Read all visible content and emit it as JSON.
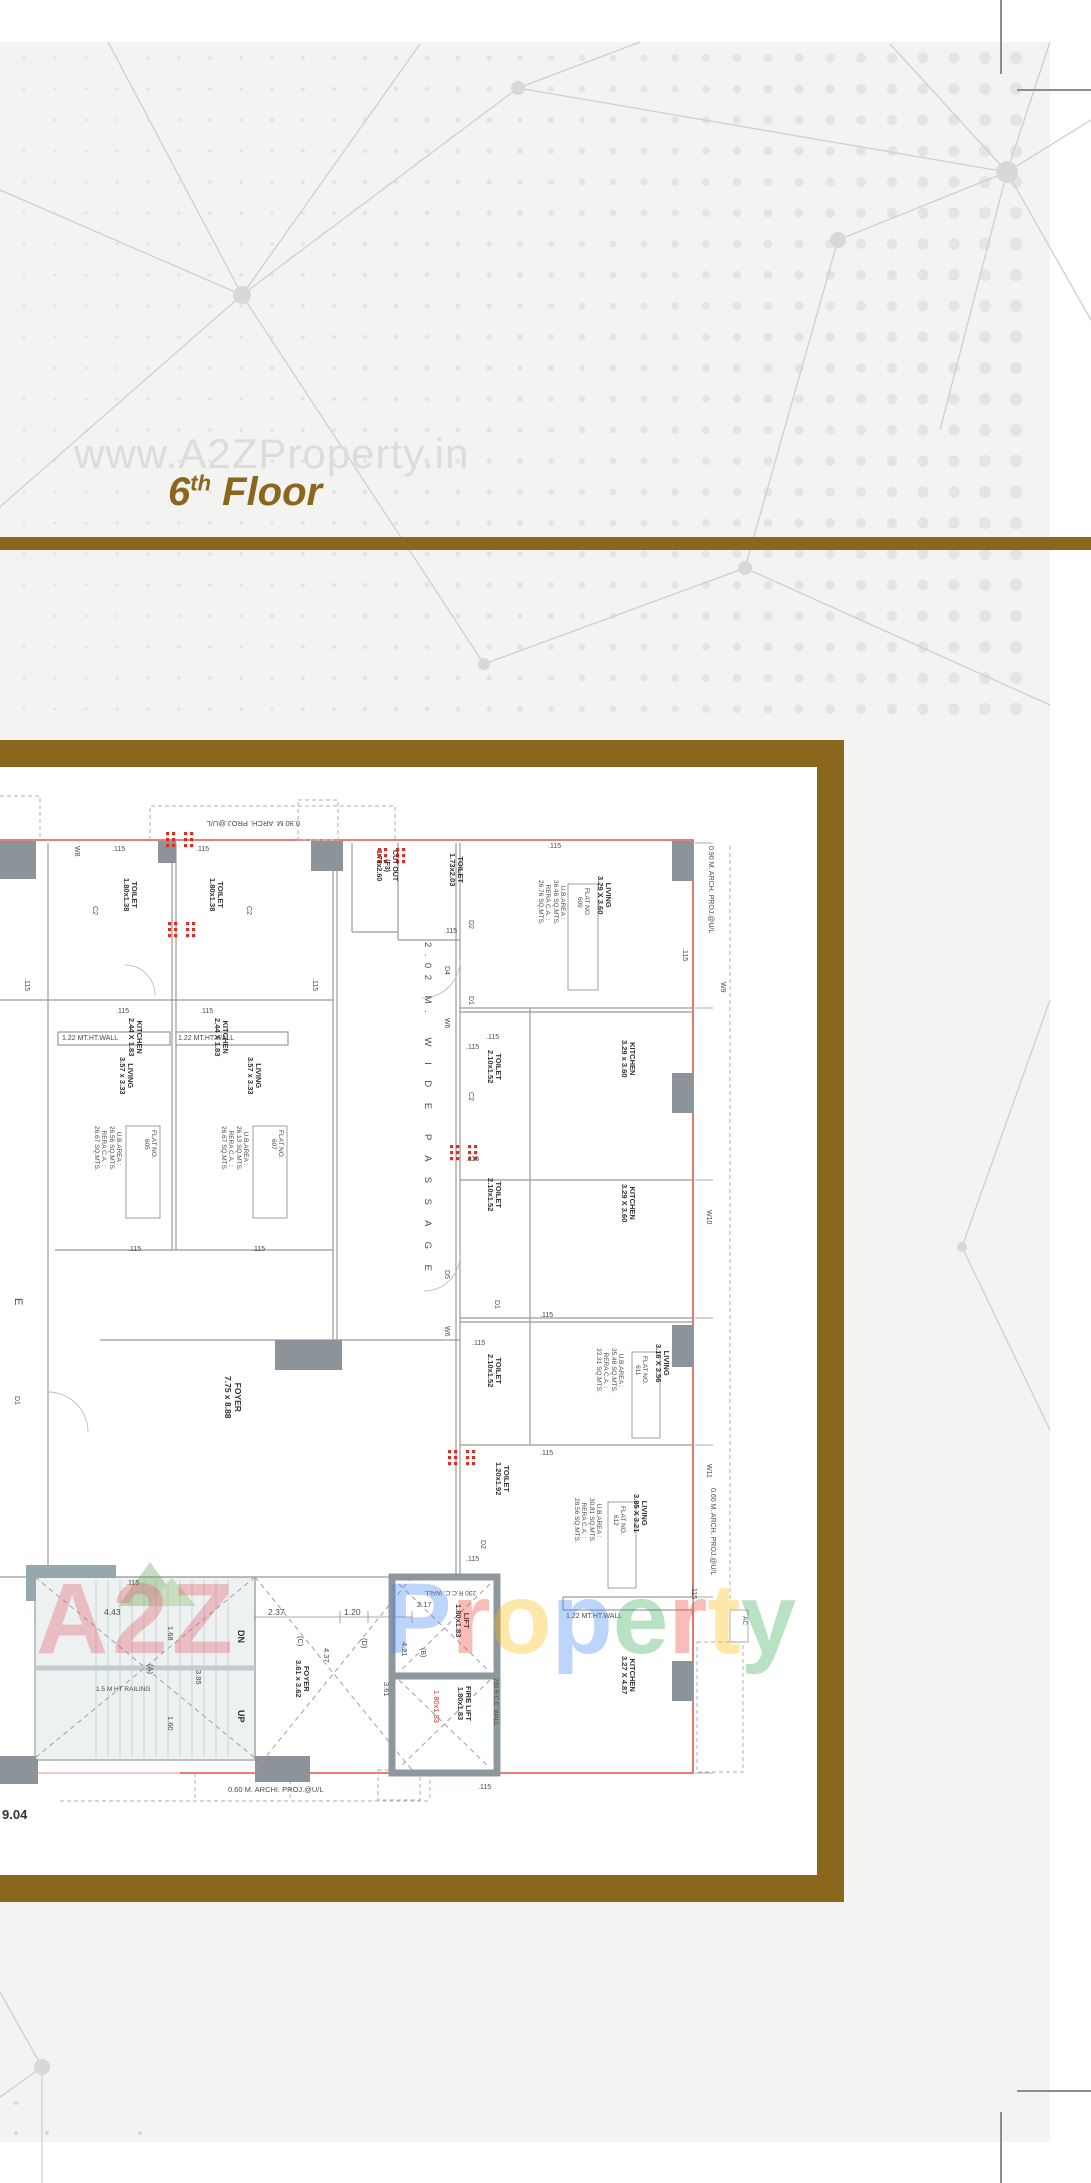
{
  "header": {
    "watermark": "www.A2ZProperty.in",
    "title": {
      "number": "6",
      "sup": "th",
      "word": " Floor"
    }
  },
  "brand_watermark": {
    "a2z": "A2Z",
    "property": "Property",
    "logo": "mountain-logo"
  },
  "colors": {
    "accent_brown": "#8a671d",
    "background_gray": "#f3f3f2",
    "plan_red_line": "#e0574d",
    "red_dot": "#d93025",
    "wm_a2z": "#e25b64",
    "wm_letters": [
      "#4285F4",
      "#EA4335",
      "#FBBC05",
      "#4285F4",
      "#34A853",
      "#EA4335",
      "#FBBC05",
      "#34A853"
    ]
  },
  "plan": {
    "labels": [
      {
        "t": "0.90 M. ARCH. PROJ.@U/L",
        "x": 300,
        "y": 827,
        "r": 180,
        "s": 7.5
      },
      {
        "t": "W8",
        "x": 80,
        "y": 846,
        "r": 90,
        "s": 7
      },
      {
        "t": ".115",
        "x": 112,
        "y": 846,
        "r": 0,
        "s": 7
      },
      {
        "t": ".115",
        "x": 196,
        "y": 846,
        "r": 0,
        "s": 7
      },
      {
        "t": ".115",
        "x": 548,
        "y": 843,
        "r": 0,
        "s": 7
      },
      {
        "t": "TOILET\n1.80x1.38",
        "x": 138,
        "y": 878,
        "r": 90,
        "s": 7.5,
        "b": 1
      },
      {
        "t": "TOILET\n1.80x1.38",
        "x": 224,
        "y": 878,
        "r": 90,
        "s": 7.5,
        "b": 1
      },
      {
        "t": "C2",
        "x": 98,
        "y": 906,
        "r": 90,
        "s": 7
      },
      {
        "t": "C2",
        "x": 252,
        "y": 906,
        "r": 90,
        "s": 7
      },
      {
        "t": "CUT OUT\n(F3)\n1.73x2.60",
        "x": 398,
        "y": 850,
        "r": 90,
        "s": 7,
        "b": 1
      },
      {
        "t": "TOILET\n1.73x2.03",
        "x": 464,
        "y": 853,
        "r": 90,
        "s": 7.5,
        "b": 1
      },
      {
        "t": ".115",
        "x": 444,
        "y": 928,
        "r": 0,
        "s": 7
      },
      {
        "t": ".115",
        "x": 30,
        "y": 978,
        "r": 90,
        "s": 7
      },
      {
        "t": ".115",
        "x": 318,
        "y": 978,
        "r": 90,
        "s": 7
      },
      {
        "t": ".115",
        "x": 116,
        "y": 1008,
        "r": 0,
        "s": 7
      },
      {
        "t": ".115",
        "x": 200,
        "y": 1008,
        "r": 0,
        "s": 7
      },
      {
        "t": "KITCHEN\n2.44 X 1.83",
        "x": 143,
        "y": 1018,
        "r": 90,
        "s": 7.5,
        "b": 1
      },
      {
        "t": "KITCHEN\n2.44 X 1.83",
        "x": 229,
        "y": 1018,
        "r": 90,
        "s": 7.5,
        "b": 1
      },
      {
        "t": "1.22 MT.HT.WALL",
        "x": 62,
        "y": 1035,
        "r": 0,
        "s": 7
      },
      {
        "t": "1.22 MT.HT.WALL",
        "x": 178,
        "y": 1035,
        "r": 0,
        "s": 7
      },
      {
        "t": "LIVING\n3.57 x 3.33",
        "x": 134,
        "y": 1057,
        "r": 90,
        "s": 7.5,
        "b": 1
      },
      {
        "t": "LIVING\n3.57 x 3.33",
        "x": 262,
        "y": 1057,
        "r": 90,
        "s": 7.5,
        "b": 1
      },
      {
        "t": "U.B.AREA :\n26.56 SQ.MTS.\nRERA C.A. :\n26.67 SQ.MTS.",
        "x": 122,
        "y": 1126,
        "r": 90,
        "s": 6.5
      },
      {
        "t": "FLAT NO.\n605",
        "x": 157,
        "y": 1130,
        "r": 90,
        "s": 6.5
      },
      {
        "t": "U.B.AREA :\n26.13 SQ.MTS.\nRERA C.A. :\n26.67 SQ.MTS.",
        "x": 249,
        "y": 1126,
        "r": 90,
        "s": 6.5
      },
      {
        "t": "FLAT NO.\n607",
        "x": 284,
        "y": 1130,
        "r": 90,
        "s": 6.5
      },
      {
        "t": ".115",
        "x": 128,
        "y": 1246,
        "r": 0,
        "s": 7
      },
      {
        "t": ".115",
        "x": 252,
        "y": 1246,
        "r": 0,
        "s": 7
      },
      {
        "t": "2.02 M.  W I D E  P A S S A G E",
        "x": 432,
        "y": 942,
        "r": 90,
        "s": 9.5,
        "ls": 6.5
      },
      {
        "t": "E",
        "x": 24,
        "y": 1298,
        "r": 90,
        "s": 11
      },
      {
        "t": "D1",
        "x": 20,
        "y": 1396,
        "r": 90,
        "s": 7
      },
      {
        "t": "FOYER\n7.75 x 8.88",
        "x": 242,
        "y": 1376,
        "r": 90,
        "s": 8.5,
        "b": 1
      },
      {
        "t": "LIVING\n3.29 X 3.60",
        "x": 612,
        "y": 876,
        "r": 90,
        "s": 7.5,
        "b": 1
      },
      {
        "t": "FLAT NO.\n609",
        "x": 590,
        "y": 888,
        "r": 90,
        "s": 6.5
      },
      {
        "t": "U.B.AREA :\n36.46 SQ.MTS.\nRERA C.A. :\n26.76 SQ.MTS.",
        "x": 566,
        "y": 880,
        "r": 90,
        "s": 6.5
      },
      {
        "t": ".115",
        "x": 688,
        "y": 948,
        "r": 90,
        "s": 7
      },
      {
        "t": "0.90 M. ARCH. PROJ.@U/L",
        "x": 714,
        "y": 846,
        "r": 90,
        "s": 7
      },
      {
        "t": "W9",
        "x": 726,
        "y": 982,
        "r": 90,
        "s": 7
      },
      {
        "t": "D2",
        "x": 474,
        "y": 920,
        "r": 90,
        "s": 7
      },
      {
        "t": "D4",
        "x": 450,
        "y": 966,
        "r": 90,
        "s": 7
      },
      {
        "t": "D1",
        "x": 474,
        "y": 996,
        "r": 90,
        "s": 7
      },
      {
        "t": "W6",
        "x": 450,
        "y": 1018,
        "r": 90,
        "s": 7
      },
      {
        "t": ".115",
        "x": 486,
        "y": 1034,
        "r": 0,
        "s": 7
      },
      {
        "t": "KITCHEN\n3.29 x 3.60",
        "x": 636,
        "y": 1040,
        "r": 90,
        "s": 7.5,
        "b": 1
      },
      {
        "t": "TOILET\n2.10x1.52",
        "x": 502,
        "y": 1050,
        "r": 90,
        "s": 7.5,
        "b": 1
      },
      {
        "t": ".115",
        "x": 466,
        "y": 1044,
        "r": 0,
        "s": 7
      },
      {
        "t": "C2",
        "x": 474,
        "y": 1092,
        "r": 90,
        "s": 7
      },
      {
        "t": "TOILET\n2.10x1.52",
        "x": 502,
        "y": 1178,
        "r": 90,
        "s": 7.5,
        "b": 1
      },
      {
        "t": ".115",
        "x": 466,
        "y": 1156,
        "r": 0,
        "s": 7
      },
      {
        "t": "KITCHEN\n3.29 X 3.60",
        "x": 636,
        "y": 1184,
        "r": 90,
        "s": 7.5,
        "b": 1
      },
      {
        "t": "W10",
        "x": 712,
        "y": 1210,
        "r": 90,
        "s": 7
      },
      {
        "t": ".115",
        "x": 540,
        "y": 1312,
        "r": 0,
        "s": 7
      },
      {
        "t": "D5",
        "x": 450,
        "y": 1270,
        "r": 90,
        "s": 7
      },
      {
        "t": "D1",
        "x": 500,
        "y": 1300,
        "r": 90,
        "s": 7
      },
      {
        "t": "W6",
        "x": 450,
        "y": 1326,
        "r": 90,
        "s": 7
      },
      {
        "t": ".115",
        "x": 472,
        "y": 1340,
        "r": 0,
        "s": 7
      },
      {
        "t": "TOILET\n2.10x1.52",
        "x": 502,
        "y": 1354,
        "r": 90,
        "s": 7.5,
        "b": 1
      },
      {
        "t": "LIVING\n3.16 X 3.56",
        "x": 670,
        "y": 1344,
        "r": 90,
        "s": 7.5,
        "b": 1
      },
      {
        "t": "FLAT NO.\n611",
        "x": 648,
        "y": 1356,
        "r": 90,
        "s": 6.5
      },
      {
        "t": "U.B.AREA :\n35.48 SQ.MTS.\nRERA C.A. :\n33.31 SQ.MTS.",
        "x": 624,
        "y": 1348,
        "r": 90,
        "s": 6.5
      },
      {
        "t": ".115",
        "x": 540,
        "y": 1450,
        "r": 0,
        "s": 7
      },
      {
        "t": "TOILET\n1.20x1.92",
        "x": 510,
        "y": 1462,
        "r": 90,
        "s": 7.5,
        "b": 1
      },
      {
        "t": ".115",
        "x": 466,
        "y": 1556,
        "r": 0,
        "s": 7
      },
      {
        "t": "D2",
        "x": 486,
        "y": 1540,
        "r": 90,
        "s": 7
      },
      {
        "t": "LIVING\n3.85 X 3.21",
        "x": 648,
        "y": 1494,
        "r": 90,
        "s": 7.5,
        "b": 1
      },
      {
        "t": "FLAT NO.\n612",
        "x": 626,
        "y": 1506,
        "r": 90,
        "s": 6.5
      },
      {
        "t": "U.B.AREA :\n30.81 SQ.MTS.\nRERA C.A. :\n28.56 SQ.MTS.",
        "x": 602,
        "y": 1498,
        "r": 90,
        "s": 6.5
      },
      {
        "t": "W11",
        "x": 712,
        "y": 1464,
        "r": 90,
        "s": 7
      },
      {
        "t": "0.60 M. ARCH. PROJ.@U/L",
        "x": 716,
        "y": 1488,
        "r": 90,
        "s": 7
      },
      {
        "t": "1.22 MT.HT.WALL",
        "x": 566,
        "y": 1613,
        "r": 0,
        "s": 7
      },
      {
        "t": "KITCHEN\n3.27 X 4.87",
        "x": 636,
        "y": 1656,
        "r": 90,
        "s": 7.5,
        "b": 1
      },
      {
        "t": "AC",
        "x": 748,
        "y": 1616,
        "r": 90,
        "s": 6.5
      },
      {
        "t": ".115",
        "x": 697,
        "y": 1586,
        "r": 90,
        "s": 7
      },
      {
        "t": ".115",
        "x": 478,
        "y": 1784,
        "r": 0,
        "s": 7
      },
      {
        "t": "230 R.C.C. WALL",
        "x": 476,
        "y": 1596,
        "r": 180,
        "s": 6.5
      },
      {
        "t": "2.17",
        "x": 417,
        "y": 1601,
        "r": 0,
        "s": 7.5
      },
      {
        "t": "LIFT\n1.80x1.83",
        "x": 470,
        "y": 1604,
        "r": 90,
        "s": 7.5,
        "b": 1
      },
      {
        "t": "(B)",
        "x": 426,
        "y": 1648,
        "r": 90,
        "s": 7
      },
      {
        "t": "4.21",
        "x": 408,
        "y": 1642,
        "r": 90,
        "s": 7.5
      },
      {
        "t": "FIRE LIFT\n1.80x1.83",
        "x": 472,
        "y": 1686,
        "r": 90,
        "s": 7.5,
        "b": 1
      },
      {
        "t": "1.80x1.83",
        "x": 440,
        "y": 1690,
        "r": 90,
        "s": 7.5,
        "c": "red"
      },
      {
        "t": "230 R.C.C. WALL",
        "x": 498,
        "y": 1678,
        "r": 90,
        "s": 6
      },
      {
        "t": ".115",
        "x": 126,
        "y": 1580,
        "r": 0,
        "s": 7
      },
      {
        "t": "4.43",
        "x": 104,
        "y": 1608,
        "r": 0,
        "s": 8.5
      },
      {
        "t": "2.37",
        "x": 268,
        "y": 1608,
        "r": 0,
        "s": 8.5
      },
      {
        "t": "1.20",
        "x": 344,
        "y": 1608,
        "r": 0,
        "s": 8.5
      },
      {
        "t": "1.68",
        "x": 174,
        "y": 1626,
        "r": 90,
        "s": 7.5
      },
      {
        "t": "(A)",
        "x": 154,
        "y": 1664,
        "r": 90,
        "s": 7.5
      },
      {
        "t": "3.85",
        "x": 202,
        "y": 1670,
        "r": 90,
        "s": 7.5
      },
      {
        "t": "1.60",
        "x": 174,
        "y": 1716,
        "r": 90,
        "s": 7.5
      },
      {
        "t": "1.5 M HT RAILING",
        "x": 96,
        "y": 1686,
        "r": 0,
        "s": 6.5
      },
      {
        "t": "DN",
        "x": 246,
        "y": 1630,
        "r": 90,
        "s": 9,
        "b": 1
      },
      {
        "t": "UP",
        "x": 246,
        "y": 1710,
        "r": 90,
        "s": 9,
        "b": 1
      },
      {
        "t": "FOYER\n3.61 x 3.62",
        "x": 310,
        "y": 1660,
        "r": 90,
        "s": 7.5,
        "b": 1
      },
      {
        "t": "(C)",
        "x": 304,
        "y": 1636,
        "r": 90,
        "s": 7.5
      },
      {
        "t": "4.37",
        "x": 330,
        "y": 1648,
        "r": 90,
        "s": 7.5
      },
      {
        "t": "(D)",
        "x": 368,
        "y": 1638,
        "r": 90,
        "s": 7.5
      },
      {
        "t": "3.61",
        "x": 390,
        "y": 1682,
        "r": 90,
        "s": 7.5
      },
      {
        "t": "0.60 M. ARCHI. PROJ.@U/L",
        "x": 228,
        "y": 1786,
        "r": 0,
        "s": 7.5
      },
      {
        "t": "9.04",
        "x": 2,
        "y": 1808,
        "r": 0,
        "s": 13,
        "b": 1
      }
    ]
  }
}
